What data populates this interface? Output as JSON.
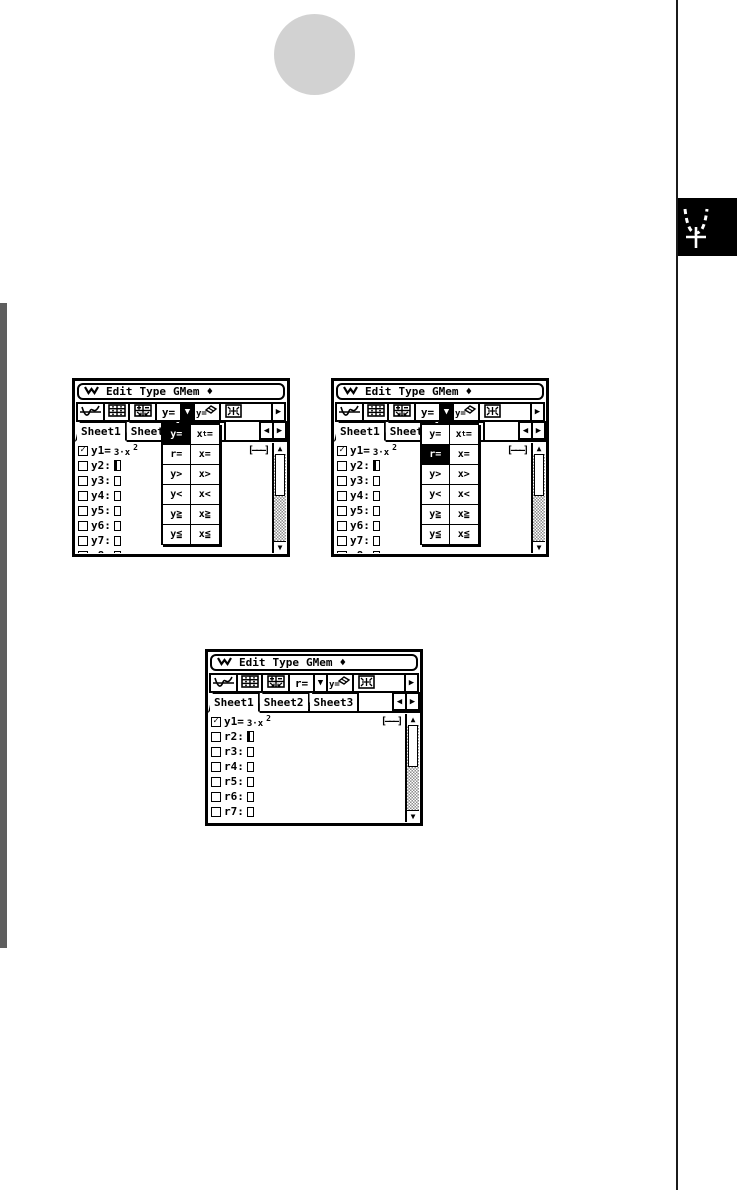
{
  "decor": {
    "circle_color": "#d2d2d2",
    "left_bar_color": "#5e5e5e",
    "right_rule_color": "#1b1b1b",
    "chapter_tab_color": "#000000"
  },
  "glyphs": {
    "diamond": "♦",
    "tab_left": "◀",
    "tab_right": "▶",
    "scroll_up": "▲",
    "scroll_down": "▼",
    "dropdown_arrow": "▼",
    "more": "▶",
    "check": "✓"
  },
  "dropdown_cells": [
    [
      "y=",
      "xt="
    ],
    [
      "r=",
      "x="
    ],
    [
      "y>",
      "x>"
    ],
    [
      "y<",
      "x<"
    ],
    [
      "y≧",
      "x≧"
    ],
    [
      "y≦",
      "x≦"
    ]
  ],
  "screens": [
    {
      "name": "graph-editor-type-menu-y-selected",
      "menu": {
        "items": [
          "Edit",
          "Type",
          "GMem"
        ]
      },
      "toolbar": {
        "type_label": "y=",
        "dropdown_pressed": true
      },
      "tabs": {
        "labels": [
          "Sheet1",
          "Sheet2",
          "Sheet3"
        ],
        "active_index": 0
      },
      "dropdown": {
        "open": true,
        "selected": "y="
      },
      "entries": [
        {
          "label": "y1=",
          "checked": true,
          "expr_base": "3·x",
          "expr_sup": "2",
          "style_indicator": "[———]"
        },
        {
          "label": "y2:",
          "cursor": true
        },
        {
          "label": "y3:"
        },
        {
          "label": "y4:"
        },
        {
          "label": "y5:"
        },
        {
          "label": "y6:"
        },
        {
          "label": "y7:"
        },
        {
          "label": "y8:"
        }
      ]
    },
    {
      "name": "graph-editor-type-menu-r-selected",
      "menu": {
        "items": [
          "Edit",
          "Type",
          "GMem"
        ]
      },
      "toolbar": {
        "type_label": "y=",
        "dropdown_pressed": true
      },
      "tabs": {
        "labels": [
          "Sheet1",
          "Sheet2",
          "Sheet3"
        ],
        "active_index": 0
      },
      "dropdown": {
        "open": true,
        "selected": "r="
      },
      "entries": [
        {
          "label": "y1=",
          "checked": true,
          "expr_base": "3·x",
          "expr_sup": "2",
          "style_indicator": "[———]"
        },
        {
          "label": "y2:",
          "cursor": true
        },
        {
          "label": "y3:"
        },
        {
          "label": "y4:"
        },
        {
          "label": "y5:"
        },
        {
          "label": "y6:"
        },
        {
          "label": "y7:"
        },
        {
          "label": "y8:"
        }
      ]
    },
    {
      "name": "graph-editor-r-type-applied",
      "menu": {
        "items": [
          "Edit",
          "Type",
          "GMem"
        ]
      },
      "toolbar": {
        "type_label": "r=",
        "dropdown_pressed": false
      },
      "tabs": {
        "labels": [
          "Sheet1",
          "Sheet2",
          "Sheet3"
        ],
        "active_index": 0
      },
      "dropdown": {
        "open": false,
        "selected": ""
      },
      "entries": [
        {
          "label": "y1=",
          "checked": true,
          "expr_base": "3·x",
          "expr_sup": "2",
          "style_indicator": "[———]"
        },
        {
          "label": "r2:",
          "cursor": true
        },
        {
          "label": "r3:"
        },
        {
          "label": "r4:"
        },
        {
          "label": "r5:"
        },
        {
          "label": "r6:"
        },
        {
          "label": "r7:"
        },
        {
          "label": "r8:"
        }
      ]
    }
  ]
}
